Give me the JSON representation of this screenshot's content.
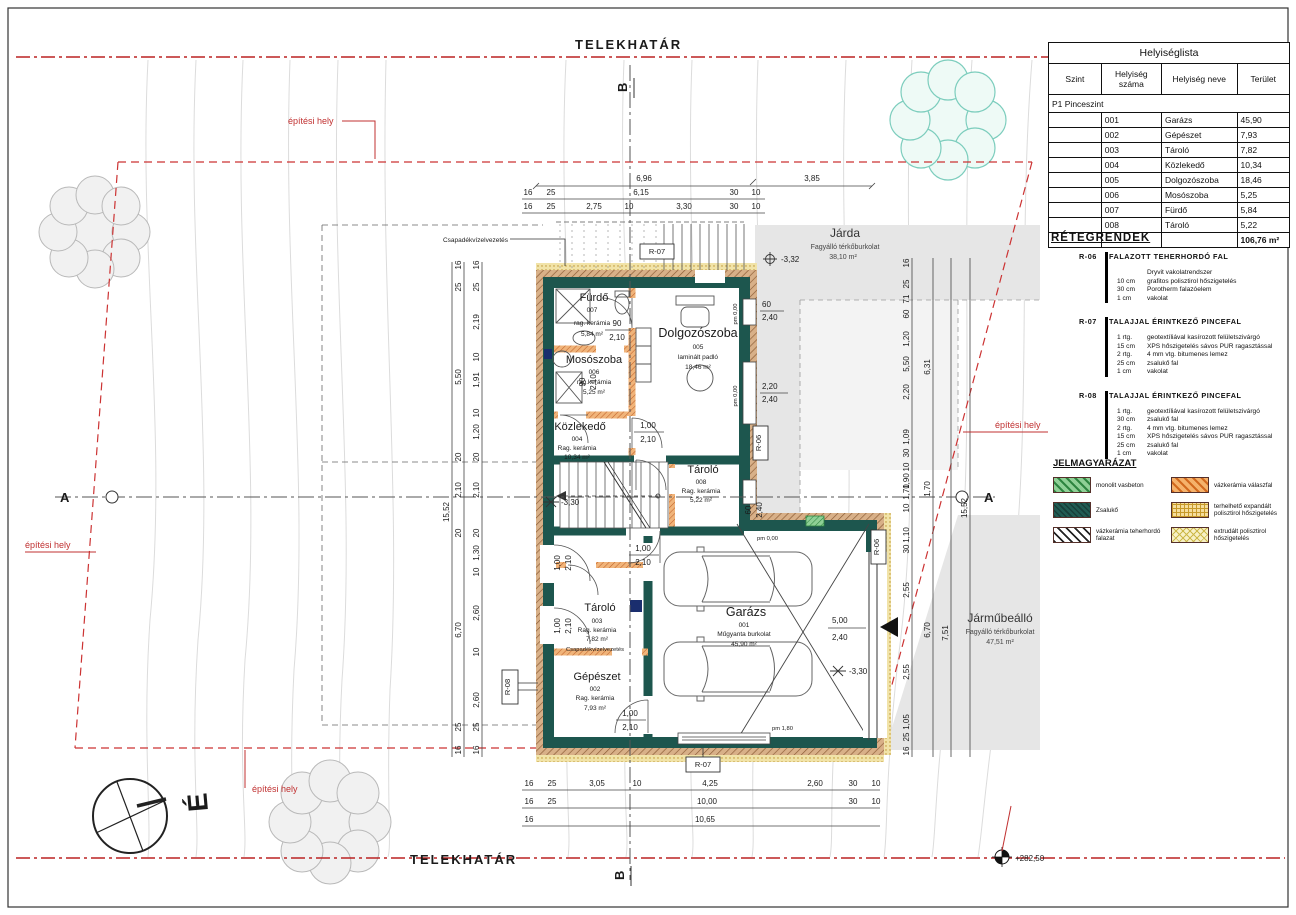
{
  "plan": {
    "telekhatar": "TELEKHATÁR",
    "epitesi_hely": "építési hely",
    "north": "É",
    "benchmark": "+282,50",
    "csapadek": "Csapadékvízelvezetés",
    "sectionA": "A",
    "sectionB": "B",
    "pm000": "pm 0,00",
    "pm180": "pm 1,80",
    "levels": {
      "jarda": "-3,32",
      "stairs": "-3,30",
      "garage": "-3,30"
    },
    "tags": {
      "r06": "R-06",
      "r07": "R-07",
      "r08": "R-08"
    }
  },
  "zones": {
    "jarda": {
      "name": "Járda",
      "surface": "Fagyálló térkőburkolat",
      "area": "38,10 m²"
    },
    "jarmubeallo": {
      "name": "Járműbeálló",
      "surface": "Fagyálló térkőburkolat",
      "area": "47,51 m²"
    }
  },
  "rooms": {
    "furdo": {
      "name": "Fürdő",
      "num": "007",
      "floor": "rag. kerámia",
      "area": "5,84 m²"
    },
    "mososzoba": {
      "name": "Mosószoba",
      "num": "006",
      "floor": "rag.kerámia",
      "area": "5,25 m²"
    },
    "kozlekedo": {
      "name": "Közlekedő",
      "num": "004",
      "floor": "Rag. kerámia",
      "area": "10,34 m²"
    },
    "dolgozoszoba": {
      "name": "Dolgozószoba",
      "num": "005",
      "floor": "laminált padló",
      "area": "18,46 m²"
    },
    "tarolo008": {
      "name": "Tároló",
      "num": "008",
      "floor": "Rag. kerámia",
      "area": "5,22 m²"
    },
    "tarolo003": {
      "name": "Tároló",
      "num": "003",
      "floor": "Rag. kerámia",
      "area": "7,82 m²",
      "note": "Csapadékvízelvezetés"
    },
    "gepeszet": {
      "name": "Gépészet",
      "num": "002",
      "floor": "Rag. kerámia",
      "area": "7,93 m²"
    },
    "garazs": {
      "name": "Garázs",
      "num": "001",
      "floor": "Műgyanta burkolat",
      "area": "45,90 m²"
    }
  },
  "openings": {
    "d90": {
      "w": "90",
      "h": "2,10"
    },
    "d100": {
      "w": "1,00",
      "h": "2,10"
    },
    "garage": {
      "w": "5,00",
      "h": "2,40"
    },
    "w60": {
      "w": "60",
      "h": "2,40"
    },
    "w220": {
      "w": "2,20",
      "h": "2,40"
    }
  },
  "dims": {
    "top1": [
      "6,96",
      "3,85"
    ],
    "top2": [
      "16",
      "25",
      "6,15",
      "30",
      "10"
    ],
    "top3": [
      "16",
      "25",
      "2,75",
      "10",
      "3,30",
      "30",
      "10"
    ],
    "bottom1": [
      "16",
      "25",
      "3,05",
      "10",
      "4,25",
      "2,60",
      "30",
      "10"
    ],
    "bottom2": [
      "16",
      "25",
      "10,00",
      "30",
      "10"
    ],
    "bottom3": [
      "16",
      "10,65"
    ],
    "left_total": "15,52",
    "left_mid": [
      "16",
      "25",
      "5,50",
      "20",
      "2,10",
      "20",
      "6,70",
      "25",
      "16"
    ],
    "left_inner": [
      "16",
      "25",
      "2,19",
      "10",
      "1,91",
      "10",
      "1,20",
      "20",
      "2,10",
      "20",
      "1,30",
      "10",
      "2,60",
      "10",
      "2,60",
      "25",
      "16"
    ],
    "right_total": "15,52",
    "right_mid": [
      "6,31",
      "1,70",
      "6,70"
    ],
    "right_mid2": [
      "7,51"
    ],
    "right_inner": [
      "16",
      "25",
      "71",
      "60",
      "1,20",
      "5,50",
      "2,20",
      "1,09",
      "30",
      "10",
      "1,90",
      "1,70",
      "10",
      "1,10",
      "30",
      "2,55",
      "2,55",
      "1,05",
      "25",
      "16"
    ]
  },
  "roomlist": {
    "title": "Helyiséglista",
    "headers": [
      "Szint",
      "Helyiség száma",
      "Helyiség neve",
      "Terület"
    ],
    "group": "P1 Pinceszint",
    "rows": [
      {
        "num": "001",
        "name": "Garázs",
        "area": "45,90"
      },
      {
        "num": "002",
        "name": "Gépészet",
        "area": "7,93"
      },
      {
        "num": "003",
        "name": "Tároló",
        "area": "7,82"
      },
      {
        "num": "004",
        "name": "Közlekedő",
        "area": "10,34"
      },
      {
        "num": "005",
        "name": "Dolgozószoba",
        "area": "18,46"
      },
      {
        "num": "006",
        "name": "Mosószoba",
        "area": "5,25"
      },
      {
        "num": "007",
        "name": "Fürdő",
        "area": "5,84"
      },
      {
        "num": "008",
        "name": "Tároló",
        "area": "5,22"
      }
    ],
    "total": "106,76 m²"
  },
  "retegrendek": {
    "title": "RÉTEGRENDEK",
    "items": [
      {
        "code": "R-06",
        "name": "FALAZOTT TEHERHORDÓ FAL",
        "layers": [
          {
            "qty": "",
            "desc": "Dryvit vakolatrendszer"
          },
          {
            "qty": "10 cm",
            "desc": "grafitos polisztirol hőszigetelés"
          },
          {
            "qty": "30 cm",
            "desc": "Porotherm falazóelem"
          },
          {
            "qty": "1 cm",
            "desc": "vakolat"
          }
        ]
      },
      {
        "code": "R-07",
        "name": "TALAJJAL ÉRINTKEZŐ PINCEFAL",
        "layers": [
          {
            "qty": "1 rtg.",
            "desc": "geotextíliával kasírozott felületszivárgó"
          },
          {
            "qty": "15 cm",
            "desc": "XPS hőszigetelés sávos PUR ragasztással"
          },
          {
            "qty": "2 rtg.",
            "desc": "4 mm vtg. bitumenes lemez"
          },
          {
            "qty": "25 cm",
            "desc": "zsalukő fal"
          },
          {
            "qty": "1 cm",
            "desc": "vakolat"
          }
        ]
      },
      {
        "code": "R-08",
        "name": "TALAJJAL ÉRINTKEZŐ PINCEFAL",
        "layers": [
          {
            "qty": "1 rtg.",
            "desc": "geotextíliával kasírozott felületszivárgó"
          },
          {
            "qty": "30 cm",
            "desc": "zsalukő fal"
          },
          {
            "qty": "2 rtg.",
            "desc": "4 mm vtg. bitumenes lemez"
          },
          {
            "qty": "15 cm",
            "desc": "XPS hőszigetelés sávos PUR ragasztással"
          },
          {
            "qty": "25 cm",
            "desc": "zsalukő fal"
          },
          {
            "qty": "1 cm",
            "desc": "vakolat"
          }
        ]
      }
    ]
  },
  "legend": {
    "title": "JELMAGYARÁZAT",
    "items": [
      {
        "label": "monolit vasbeton"
      },
      {
        "label": "Zsalukő"
      },
      {
        "label": "vázkerámia teherhordó falazat"
      },
      {
        "label": "vázkerámia válaszfal"
      },
      {
        "label": "terhelhető expandált polisztirol hőszigetelés"
      },
      {
        "label": "extrudált polisztirol hőszigetelés"
      }
    ]
  }
}
